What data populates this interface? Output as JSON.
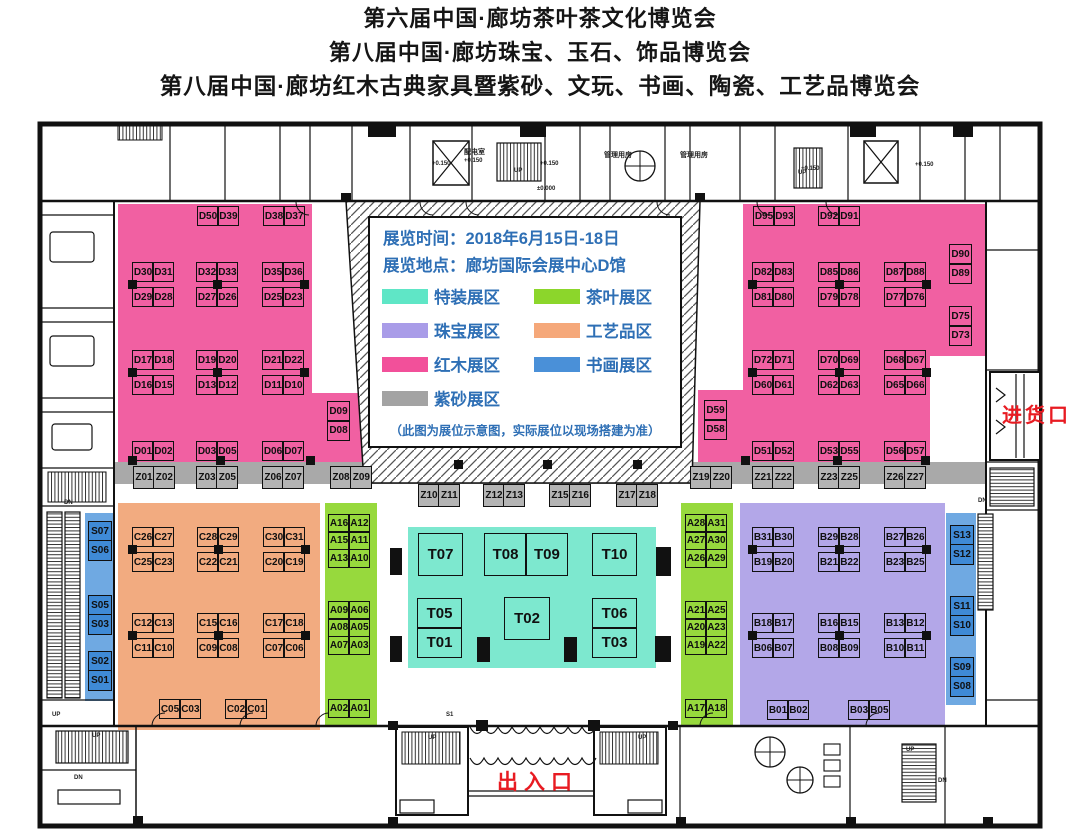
{
  "titles": [
    "第六届中国·廊坊茶叶茶文化博览会",
    "第八届中国·廊坊珠宝、玉石、饰品博览会",
    "第八届中国·廊坊红木古典家具暨紫砂、文玩、书画、陶瓷、工艺品博览会"
  ],
  "info_box": {
    "time_label": "展览时间：2018年6月15日-18日",
    "place_label": "展览地点：廊坊国际会展中心D馆",
    "note": "（此图为展位示意图，实际展位以现场搭建为准）",
    "text_color": "#2e6fb5"
  },
  "legend": {
    "items": [
      {
        "label": "特装展区",
        "color": "#5fe6c6"
      },
      {
        "label": "茶叶展区",
        "color": "#8cd62b"
      },
      {
        "label": "珠宝展区",
        "color": "#a99ce8"
      },
      {
        "label": "工艺品区",
        "color": "#f5a87a"
      },
      {
        "label": "红木展区",
        "color": "#f2509a"
      },
      {
        "label": "书画展区",
        "color": "#4a90d8"
      },
      {
        "label": "紫砂展区",
        "color": "#a3a3a3"
      }
    ]
  },
  "colors": {
    "special": "#7de8cf",
    "tea": "#97d93d",
    "jewelry": "#b3a7e8",
    "crafts": "#f2ab80",
    "redwood": "#f160a2",
    "zisha_strip": "#a9a9a9",
    "zisha_booth": "#b4b4b4",
    "calligraphy_strip": "#6fa9e2",
    "calligraphy_booth": "#3f8ad6",
    "entrance_red": "#e81b22",
    "legend_text_blue": "#2e6fb5"
  },
  "entrances": {
    "goods": "进货口",
    "main": "出入口"
  },
  "booths": [
    {
      "cls": "d",
      "x": 197,
      "y": 206,
      "rows": [
        [
          "D50",
          "D39"
        ]
      ]
    },
    {
      "cls": "d",
      "x": 263,
      "y": 206,
      "rows": [
        [
          "D38",
          "D37"
        ]
      ]
    },
    {
      "cls": "d",
      "x": 132,
      "y": 262,
      "gap": 7,
      "conn": "l",
      "rows": [
        [
          "D30",
          "D31"
        ],
        [
          "D29",
          "D28"
        ]
      ]
    },
    {
      "cls": "d",
      "x": 196,
      "y": 262,
      "gap": 7,
      "conn": "c",
      "rows": [
        [
          "D32",
          "D33"
        ],
        [
          "D27",
          "D26"
        ]
      ]
    },
    {
      "cls": "d",
      "x": 262,
      "y": 262,
      "gap": 7,
      "conn": "r",
      "rows": [
        [
          "D35",
          "D36"
        ],
        [
          "D25",
          "D23"
        ]
      ]
    },
    {
      "cls": "d",
      "x": 132,
      "y": 350,
      "gap": 7,
      "conn": "l",
      "rows": [
        [
          "D17",
          "D18"
        ],
        [
          "D16",
          "D15"
        ]
      ]
    },
    {
      "cls": "d",
      "x": 196,
      "y": 350,
      "gap": 7,
      "conn": "c",
      "rows": [
        [
          "D19",
          "D20"
        ],
        [
          "D13",
          "D12"
        ]
      ]
    },
    {
      "cls": "d",
      "x": 262,
      "y": 350,
      "gap": 7,
      "conn": "r",
      "rows": [
        [
          "D21",
          "D22"
        ],
        [
          "D11",
          "D10"
        ]
      ]
    },
    {
      "cls": "d",
      "x": 132,
      "y": 441,
      "rows": [
        [
          "D01",
          "D02"
        ]
      ]
    },
    {
      "cls": "d",
      "x": 196,
      "y": 441,
      "rows": [
        [
          "D03",
          "D05"
        ]
      ]
    },
    {
      "cls": "d",
      "x": 262,
      "y": 441,
      "rows": [
        [
          "D06",
          "D07"
        ]
      ]
    },
    {
      "cls": "d",
      "x": 327,
      "y": 401,
      "cw": 23,
      "ch": 21,
      "rows": [
        [
          "D09"
        ],
        [
          "D08"
        ]
      ]
    },
    {
      "cls": "d",
      "x": 753,
      "y": 206,
      "rows": [
        [
          "D95",
          "D93"
        ]
      ]
    },
    {
      "cls": "d",
      "x": 818,
      "y": 206,
      "rows": [
        [
          "D92",
          "D91"
        ]
      ]
    },
    {
      "cls": "d",
      "x": 949,
      "y": 244,
      "cw": 23,
      "ch": 21,
      "rows": [
        [
          "D90"
        ],
        [
          "D89"
        ]
      ]
    },
    {
      "cls": "d",
      "x": 752,
      "y": 262,
      "gap": 7,
      "conn": "l",
      "rows": [
        [
          "D82",
          "D83"
        ],
        [
          "D81",
          "D80"
        ]
      ]
    },
    {
      "cls": "d",
      "x": 818,
      "y": 262,
      "gap": 7,
      "conn": "c",
      "rows": [
        [
          "D85",
          "D86"
        ],
        [
          "D79",
          "D78"
        ]
      ]
    },
    {
      "cls": "d",
      "x": 884,
      "y": 262,
      "gap": 7,
      "conn": "r",
      "rows": [
        [
          "D87",
          "D88"
        ],
        [
          "D77",
          "D76"
        ]
      ]
    },
    {
      "cls": "d",
      "x": 949,
      "y": 306,
      "cw": 23,
      "ch": 21,
      "rows": [
        [
          "D75"
        ],
        [
          "D73"
        ]
      ]
    },
    {
      "cls": "d",
      "x": 752,
      "y": 350,
      "gap": 7,
      "conn": "l",
      "rows": [
        [
          "D72",
          "D71"
        ],
        [
          "D60",
          "D61"
        ]
      ]
    },
    {
      "cls": "d",
      "x": 818,
      "y": 350,
      "gap": 7,
      "conn": "c",
      "rows": [
        [
          "D70",
          "D69"
        ],
        [
          "D62",
          "D63"
        ]
      ]
    },
    {
      "cls": "d",
      "x": 884,
      "y": 350,
      "gap": 7,
      "conn": "r",
      "rows": [
        [
          "D68",
          "D67"
        ],
        [
          "D65",
          "D66"
        ]
      ]
    },
    {
      "cls": "d",
      "x": 704,
      "y": 400,
      "cw": 23,
      "ch": 21,
      "rows": [
        [
          "D59"
        ],
        [
          "D58"
        ]
      ]
    },
    {
      "cls": "d",
      "x": 752,
      "y": 441,
      "rows": [
        [
          "D51",
          "D52"
        ]
      ]
    },
    {
      "cls": "d",
      "x": 818,
      "y": 441,
      "rows": [
        [
          "D53",
          "D55"
        ]
      ]
    },
    {
      "cls": "d",
      "x": 884,
      "y": 441,
      "rows": [
        [
          "D56",
          "D57"
        ]
      ]
    },
    {
      "cls": "z",
      "x": 133,
      "y": 466,
      "ch": 23,
      "rows": [
        [
          "Z01",
          "Z02"
        ]
      ]
    },
    {
      "cls": "z",
      "x": 196,
      "y": 466,
      "ch": 23,
      "rows": [
        [
          "Z03",
          "Z05"
        ]
      ]
    },
    {
      "cls": "z",
      "x": 262,
      "y": 466,
      "ch": 23,
      "rows": [
        [
          "Z06",
          "Z07"
        ]
      ]
    },
    {
      "cls": "z",
      "x": 330,
      "y": 466,
      "ch": 23,
      "rows": [
        [
          "Z08",
          "Z09"
        ]
      ]
    },
    {
      "cls": "z",
      "x": 418,
      "y": 484,
      "ch": 23,
      "rows": [
        [
          "Z10",
          "Z11"
        ]
      ]
    },
    {
      "cls": "z",
      "x": 483,
      "y": 484,
      "ch": 23,
      "rows": [
        [
          "Z12",
          "Z13"
        ]
      ]
    },
    {
      "cls": "z",
      "x": 549,
      "y": 484,
      "ch": 23,
      "rows": [
        [
          "Z15",
          "Z16"
        ]
      ]
    },
    {
      "cls": "z",
      "x": 616,
      "y": 484,
      "ch": 23,
      "rows": [
        [
          "Z17",
          "Z18"
        ]
      ]
    },
    {
      "cls": "z",
      "x": 690,
      "y": 466,
      "ch": 23,
      "rows": [
        [
          "Z19",
          "Z20"
        ]
      ]
    },
    {
      "cls": "z",
      "x": 752,
      "y": 466,
      "ch": 23,
      "rows": [
        [
          "Z21",
          "Z22"
        ]
      ]
    },
    {
      "cls": "z",
      "x": 818,
      "y": 466,
      "ch": 23,
      "rows": [
        [
          "Z23",
          "Z25"
        ]
      ]
    },
    {
      "cls": "z",
      "x": 884,
      "y": 466,
      "ch": 23,
      "rows": [
        [
          "Z26",
          "Z27"
        ]
      ]
    },
    {
      "cls": "c",
      "x": 132,
      "y": 527,
      "gap": 7,
      "conn": "l",
      "rows": [
        [
          "C26",
          "C27"
        ],
        [
          "C25",
          "C23"
        ]
      ]
    },
    {
      "cls": "c",
      "x": 197,
      "y": 527,
      "gap": 7,
      "conn": "c",
      "rows": [
        [
          "C28",
          "C29"
        ],
        [
          "C22",
          "C21"
        ]
      ]
    },
    {
      "cls": "c",
      "x": 263,
      "y": 527,
      "gap": 7,
      "conn": "r",
      "rows": [
        [
          "C30",
          "C31"
        ],
        [
          "C20",
          "C19"
        ]
      ]
    },
    {
      "cls": "c",
      "x": 132,
      "y": 613,
      "gap": 7,
      "conn": "l",
      "rows": [
        [
          "C12",
          "C13"
        ],
        [
          "C11",
          "C10"
        ]
      ]
    },
    {
      "cls": "c",
      "x": 197,
      "y": 613,
      "gap": 7,
      "conn": "c",
      "rows": [
        [
          "C15",
          "C16"
        ],
        [
          "C09",
          "C08"
        ]
      ]
    },
    {
      "cls": "c",
      "x": 263,
      "y": 613,
      "gap": 7,
      "conn": "r",
      "rows": [
        [
          "C17",
          "C18"
        ],
        [
          "C07",
          "C06"
        ]
      ]
    },
    {
      "cls": "c",
      "x": 159,
      "y": 699,
      "rows": [
        [
          "C05",
          "C03"
        ]
      ]
    },
    {
      "cls": "c",
      "x": 225,
      "y": 699,
      "rows": [
        [
          "C02",
          "C01"
        ]
      ]
    },
    {
      "cls": "a",
      "x": 328,
      "y": 514,
      "ch": 19,
      "rows": [
        [
          "A16",
          "A12"
        ],
        [
          "A15",
          "A11"
        ],
        [
          "A13",
          "A10"
        ]
      ]
    },
    {
      "cls": "a",
      "x": 328,
      "y": 601,
      "ch": 19,
      "rows": [
        [
          "A09",
          "A06"
        ],
        [
          "A08",
          "A05"
        ],
        [
          "A07",
          "A03"
        ]
      ]
    },
    {
      "cls": "a",
      "x": 328,
      "y": 699,
      "ch": 19,
      "rows": [
        [
          "A02",
          "A01"
        ]
      ]
    },
    {
      "cls": "a",
      "x": 685,
      "y": 514,
      "ch": 19,
      "rows": [
        [
          "A28",
          "A31"
        ],
        [
          "A27",
          "A30"
        ],
        [
          "A26",
          "A29"
        ]
      ]
    },
    {
      "cls": "a",
      "x": 685,
      "y": 601,
      "ch": 19,
      "rows": [
        [
          "A21",
          "A25"
        ],
        [
          "A20",
          "A23"
        ],
        [
          "A19",
          "A22"
        ]
      ]
    },
    {
      "cls": "a",
      "x": 685,
      "y": 699,
      "ch": 19,
      "rows": [
        [
          "A17",
          "A18"
        ]
      ]
    },
    {
      "cls": "t",
      "x": 418,
      "y": 533,
      "cw": 45,
      "ch": 43,
      "rows": [
        [
          "T07"
        ]
      ]
    },
    {
      "cls": "t",
      "x": 484,
      "y": 533,
      "cw": 43,
      "ch": 43,
      "rows": [
        [
          "T08",
          "T09"
        ]
      ]
    },
    {
      "cls": "t",
      "x": 592,
      "y": 533,
      "cw": 45,
      "ch": 43,
      "rows": [
        [
          "T10"
        ]
      ]
    },
    {
      "cls": "t",
      "x": 417,
      "y": 598,
      "cw": 45,
      "ch": 31,
      "rows": [
        [
          "T05"
        ],
        [
          "T01"
        ]
      ]
    },
    {
      "cls": "t",
      "x": 504,
      "y": 597,
      "cw": 46,
      "ch": 43,
      "rows": [
        [
          "T02"
        ]
      ]
    },
    {
      "cls": "t",
      "x": 592,
      "y": 598,
      "cw": 45,
      "ch": 31,
      "rows": [
        [
          "T06"
        ],
        [
          "T03"
        ]
      ]
    },
    {
      "cls": "b",
      "x": 752,
      "y": 527,
      "gap": 7,
      "conn": "l",
      "rows": [
        [
          "B31",
          "B30"
        ],
        [
          "B19",
          "B20"
        ]
      ]
    },
    {
      "cls": "b",
      "x": 818,
      "y": 527,
      "gap": 7,
      "conn": "c",
      "rows": [
        [
          "B29",
          "B28"
        ],
        [
          "B21",
          "B22"
        ]
      ]
    },
    {
      "cls": "b",
      "x": 884,
      "y": 527,
      "gap": 7,
      "conn": "r",
      "rows": [
        [
          "B27",
          "B26"
        ],
        [
          "B23",
          "B25"
        ]
      ]
    },
    {
      "cls": "b",
      "x": 752,
      "y": 613,
      "gap": 7,
      "conn": "l",
      "rows": [
        [
          "B18",
          "B17"
        ],
        [
          "B06",
          "B07"
        ]
      ]
    },
    {
      "cls": "b",
      "x": 818,
      "y": 613,
      "gap": 7,
      "conn": "c",
      "rows": [
        [
          "B16",
          "B15"
        ],
        [
          "B08",
          "B09"
        ]
      ]
    },
    {
      "cls": "b",
      "x": 884,
      "y": 613,
      "gap": 7,
      "conn": "r",
      "rows": [
        [
          "B13",
          "B12"
        ],
        [
          "B10",
          "B11"
        ]
      ]
    },
    {
      "cls": "b",
      "x": 767,
      "y": 700,
      "rows": [
        [
          "B01",
          "B02"
        ]
      ]
    },
    {
      "cls": "b",
      "x": 848,
      "y": 700,
      "rows": [
        [
          "B03",
          "B05"
        ]
      ]
    },
    {
      "cls": "s",
      "x": 88,
      "y": 521,
      "cw": 24,
      "ch": 21,
      "rows": [
        [
          "S07"
        ],
        [
          "S06"
        ]
      ]
    },
    {
      "cls": "s",
      "x": 88,
      "y": 595,
      "cw": 24,
      "ch": 21,
      "rows": [
        [
          "S05"
        ],
        [
          "S03"
        ]
      ]
    },
    {
      "cls": "s",
      "x": 88,
      "y": 651,
      "cw": 24,
      "ch": 21,
      "rows": [
        [
          "S02"
        ],
        [
          "S01"
        ]
      ]
    },
    {
      "cls": "s",
      "x": 950,
      "y": 525,
      "cw": 24,
      "ch": 21,
      "rows": [
        [
          "S13"
        ],
        [
          "S12"
        ]
      ]
    },
    {
      "cls": "s",
      "x": 950,
      "y": 596,
      "cw": 24,
      "ch": 21,
      "rows": [
        [
          "S11"
        ],
        [
          "S10"
        ]
      ]
    },
    {
      "cls": "s",
      "x": 950,
      "y": 657,
      "cw": 24,
      "ch": 21,
      "rows": [
        [
          "S09"
        ],
        [
          "S08"
        ]
      ]
    }
  ],
  "small_labels": [
    {
      "t": "配电室",
      "x": 464,
      "y": 147,
      "fs": 7
    },
    {
      "t": "+0.150",
      "x": 432,
      "y": 161,
      "fs": 6
    },
    {
      "t": "+0.150",
      "x": 464,
      "y": 158,
      "fs": 6
    },
    {
      "t": "+0.150",
      "x": 540,
      "y": 161,
      "fs": 6
    },
    {
      "t": "±0.000",
      "x": 537,
      "y": 186,
      "fs": 6
    },
    {
      "t": "管理用房",
      "x": 604,
      "y": 150,
      "fs": 7
    },
    {
      "t": "管理用房",
      "x": 680,
      "y": 150,
      "fs": 7
    },
    {
      "t": "+0.150",
      "x": 801,
      "y": 166,
      "fs": 6
    },
    {
      "t": "+0.150",
      "x": 915,
      "y": 162,
      "fs": 6
    },
    {
      "t": "UP",
      "x": 514,
      "y": 168,
      "fs": 6
    },
    {
      "t": "UP",
      "x": 798,
      "y": 170,
      "fs": 6
    },
    {
      "t": "DN",
      "x": 64,
      "y": 500,
      "fs": 6
    },
    {
      "t": "UP",
      "x": 52,
      "y": 712,
      "fs": 6
    },
    {
      "t": "DN",
      "x": 978,
      "y": 498,
      "fs": 6
    },
    {
      "t": "UP",
      "x": 92,
      "y": 733,
      "fs": 6
    },
    {
      "t": "DN",
      "x": 74,
      "y": 775,
      "fs": 6
    },
    {
      "t": "S1",
      "x": 446,
      "y": 712,
      "fs": 6
    },
    {
      "t": "UP",
      "x": 428,
      "y": 735,
      "fs": 6
    },
    {
      "t": "UP",
      "x": 638,
      "y": 735,
      "fs": 6
    },
    {
      "t": "UP",
      "x": 906,
      "y": 747,
      "fs": 6
    },
    {
      "t": "DN",
      "x": 938,
      "y": 778,
      "fs": 6
    }
  ]
}
